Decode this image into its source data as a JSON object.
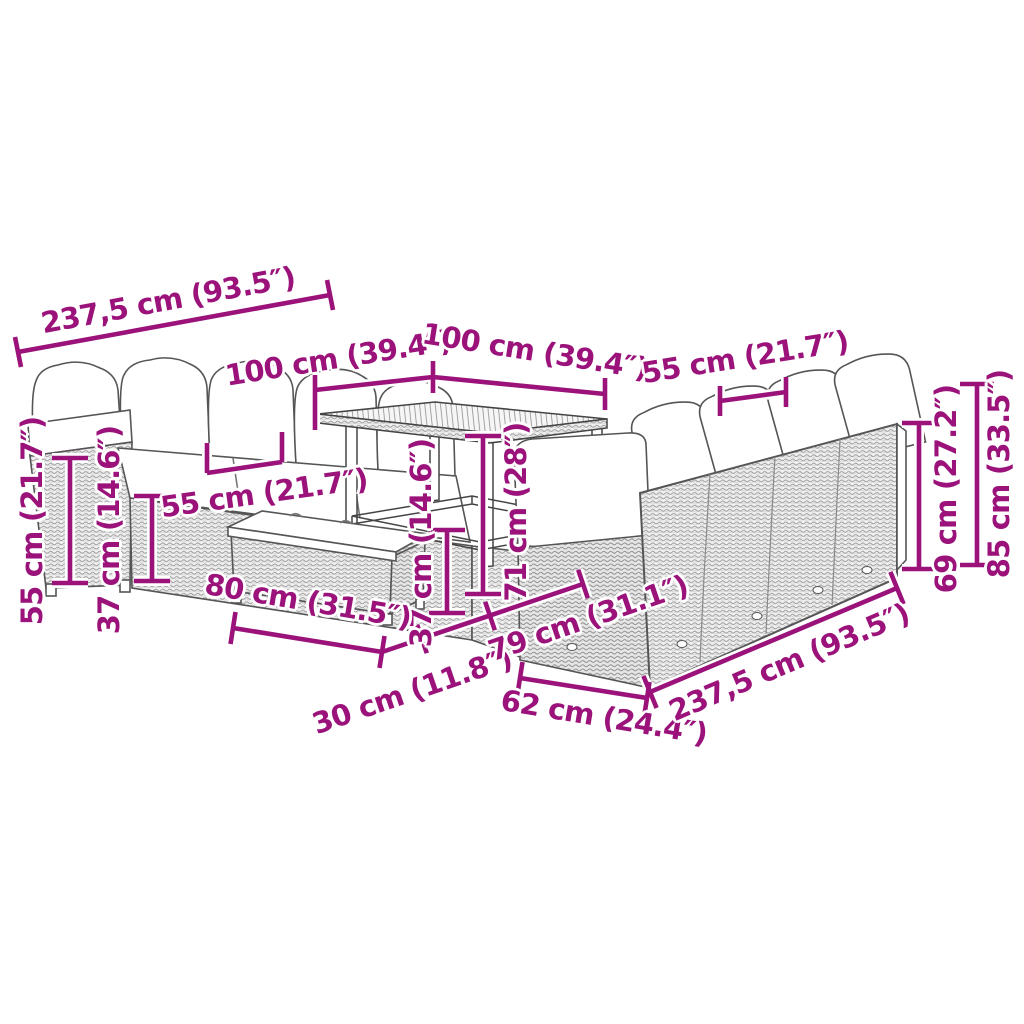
{
  "figure": {
    "type": "product-dimension-diagram",
    "subject": "poly rattan garden lounge set with sofas, cushions, bench and square table"
  },
  "colors": {
    "dimension_accent": "#9A127A",
    "outline_gray": "#444444",
    "background": "#ffffff"
  },
  "dims": {
    "top_sofa_length": {
      "label": "237,5 cm (93.5″)"
    },
    "table_width_left": {
      "label": "100 cm (39.4″)"
    },
    "table_width_right": {
      "label": "100 cm (39.4″)"
    },
    "right_seat_width": {
      "label": "55 cm (21.7″)"
    },
    "back_height": {
      "label": "69 cm (27.2″)"
    },
    "total_height": {
      "label": "85 cm (33.5″)"
    },
    "left_back_height": {
      "label": "55 cm (21.7″)"
    },
    "left_seat_height": {
      "label": "37 cm (14.6″)"
    },
    "left_seat_width": {
      "label": "55 cm (21.7″)"
    },
    "bench_height": {
      "label": "37 cm (14.6″)"
    },
    "table_height": {
      "label": "71 cm (28″)"
    },
    "bench_length": {
      "label": "80 cm (31.5″)"
    },
    "bench_depth": {
      "label": "30 cm (11.8″)"
    },
    "sofa_depth": {
      "label": "79 cm (31.1″)"
    },
    "corner_depth": {
      "label": "62 cm (24.4″)"
    },
    "bottom_sofa_length": {
      "label": "237,5 cm (93.5″)"
    }
  }
}
